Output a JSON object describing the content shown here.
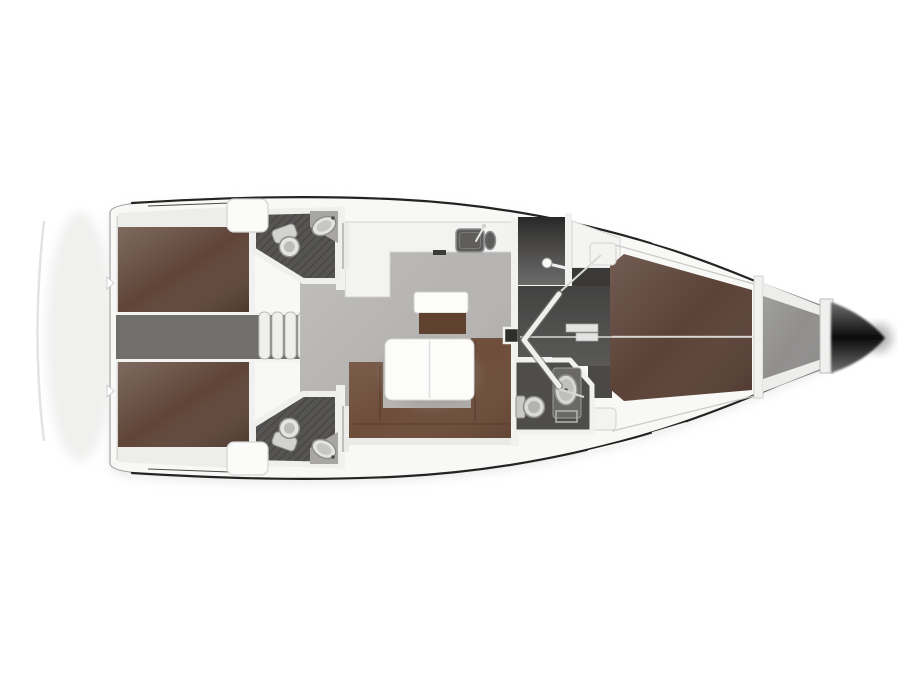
{
  "diagram": {
    "type": "sailing-yacht-interior-floor-plan",
    "view": "top-down",
    "bow_direction": "right"
  },
  "colors": {
    "background": "#ffffff",
    "hull_fill": "#f8f8f7",
    "hull_outline": "#232322",
    "stern_edge": "#b5b5b4",
    "deck_band": "#ededec",
    "wall_white": "#f1f1f0",
    "trim_line": "#c9c9c8",
    "salon_floor": "#b6b4b2",
    "corridor_floor": "#716f6d",
    "aft_berth": "#5f4538",
    "forward_berth": "#5b4237",
    "sofa": "#6e4d3a",
    "seat_bench": "#5e412f",
    "table_top": "#fcfcfb",
    "galley_counter": "#f3f3f2",
    "sink_basin": "#5e5d5c",
    "head_floor": "#555453",
    "hatch_line": "#454443",
    "dark_room": "#3a3938",
    "passage_floor": "#4a4948",
    "anchor_locker": "#908f8e",
    "bow_tip": "#0b0b0b",
    "fixture_fill": "#e3e3e2",
    "fixture_stroke": "#8e8e8d",
    "steps_tread": "#efefee",
    "shadow_soft": "#d4d4d3"
  },
  "fixtures": [
    {
      "name": "companionway-steps",
      "count": 1
    },
    {
      "name": "folding-door",
      "count": 1
    },
    {
      "name": "shower-head",
      "count": 1
    },
    {
      "name": "toilet",
      "count": 3
    },
    {
      "name": "washbasin",
      "count": 3
    },
    {
      "name": "galley-double-sink",
      "count": 1
    },
    {
      "name": "dining-table",
      "count": 1
    },
    {
      "name": "u-shaped-sofa",
      "count": 1
    },
    {
      "name": "double-berth-aft",
      "count": 2
    },
    {
      "name": "v-berth-forward",
      "count": 1
    },
    {
      "name": "anchor-locker",
      "count": 1
    },
    {
      "name": "deck-hatch",
      "count": 2
    }
  ]
}
